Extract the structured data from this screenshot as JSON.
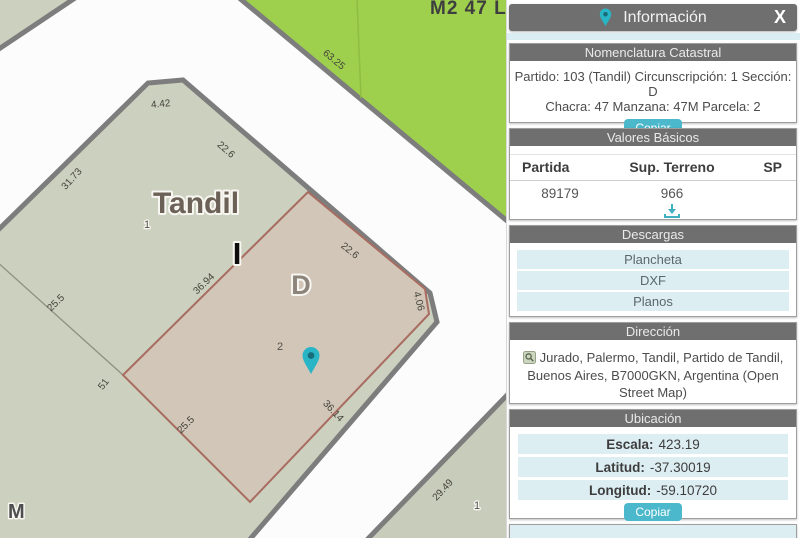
{
  "map": {
    "city_label": "Tandil",
    "block_top_label": "M2 47 L",
    "section_label": "D",
    "block_letter": "I",
    "corner_letter": "M",
    "parcel_numbers": {
      "main_block": "1",
      "selected": "2",
      "south_block": "1"
    },
    "dimensions": {
      "d63_25": "63.25",
      "d4_42": "4.42",
      "d22_6_block": "22.6",
      "d31_73": "31.73",
      "d36_94": "36.94",
      "d22_6_parcel": "22.6",
      "d4_06": "4.06",
      "d36_14": "36.14",
      "d25_5_parcel": "25.5",
      "d25_5_west": "25.5",
      "d51": "51",
      "d29_49": "29.49"
    },
    "colors": {
      "street": "#fcfcfc",
      "block_fill": "#ccd0bf",
      "block_border": "#7d7d7d",
      "green_fill": "#9ed04e",
      "parcel_fill": "#d2c6b8",
      "parcel_border": "#a86c60",
      "pin": "#2ab5c6"
    }
  },
  "panel": {
    "title": "Información",
    "close_label": "X",
    "nomenclatura": {
      "header": "Nomenclatura Catastral",
      "line1": "Partido: 103 (Tandil) Circunscripción: 1 Sección: D",
      "line2": "Chacra: 47 Manzana: 47M Parcela: 2",
      "copy_label": "Copiar"
    },
    "valores": {
      "header": "Valores Básicos",
      "columns": [
        "Partida",
        "Sup. Terreno",
        "SP"
      ],
      "partida_value": "89179",
      "sup_terreno_value": "966"
    },
    "descargas": {
      "header": "Descargas",
      "items": [
        "Plancheta",
        "DXF",
        "Planos"
      ]
    },
    "direccion": {
      "header": "Dirección",
      "text": "Jurado, Palermo, Tandil, Partido de Tandil, Buenos Aires, B7000GKN, Argentina (Open Street Map)"
    },
    "ubicacion": {
      "header": "Ubicación",
      "escala_label": "Escala:",
      "escala_value": "423.19",
      "latitud_label": "Latitud:",
      "latitud_value": "-37.30019",
      "longitud_label": "Longitud:",
      "longitud_value": "-59.10720",
      "copy_label": "Copiar"
    }
  }
}
